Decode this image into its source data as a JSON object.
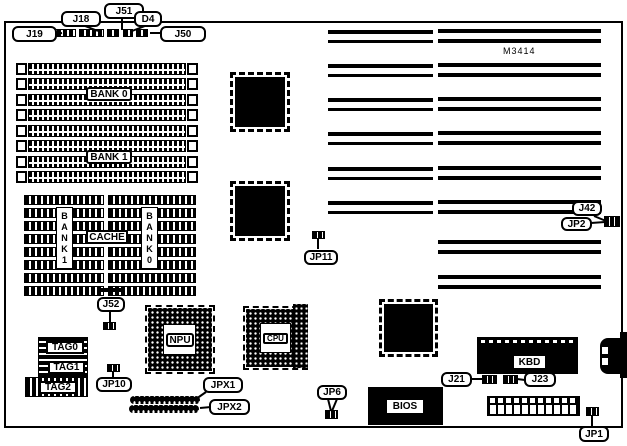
{
  "colors": {
    "ink": "#000000",
    "paper": "#ffffff"
  },
  "board": {
    "chip_label": "M3414"
  },
  "memory": {
    "bank0_label": "BANK 0",
    "bank1_label": "BANK 1"
  },
  "cache": {
    "label": "CACHE",
    "bank1_vertical": "BANK1",
    "bank0_vertical": "BANK0"
  },
  "sockets": {
    "npu_label": "NPU",
    "cpu_label": "CPU"
  },
  "tags": {
    "tag0_label": "TAG0",
    "tag1_label": "TAG1",
    "tag2_label": "TAG2"
  },
  "chips": {
    "bios_label": "BIOS",
    "kbd_label": "KBD"
  },
  "callouts": {
    "j19": "J19",
    "j18": "J18",
    "j51": "J51",
    "d4": "D4",
    "j50": "J50",
    "j42": "J42",
    "jp2": "JP2",
    "jp11": "JP11",
    "j52": "J52",
    "jp10": "JP10",
    "jpx1": "JPX1",
    "jpx2": "JPX2",
    "jp6": "JP6",
    "j21": "J21",
    "j23": "J23",
    "jp1": "JP1"
  }
}
